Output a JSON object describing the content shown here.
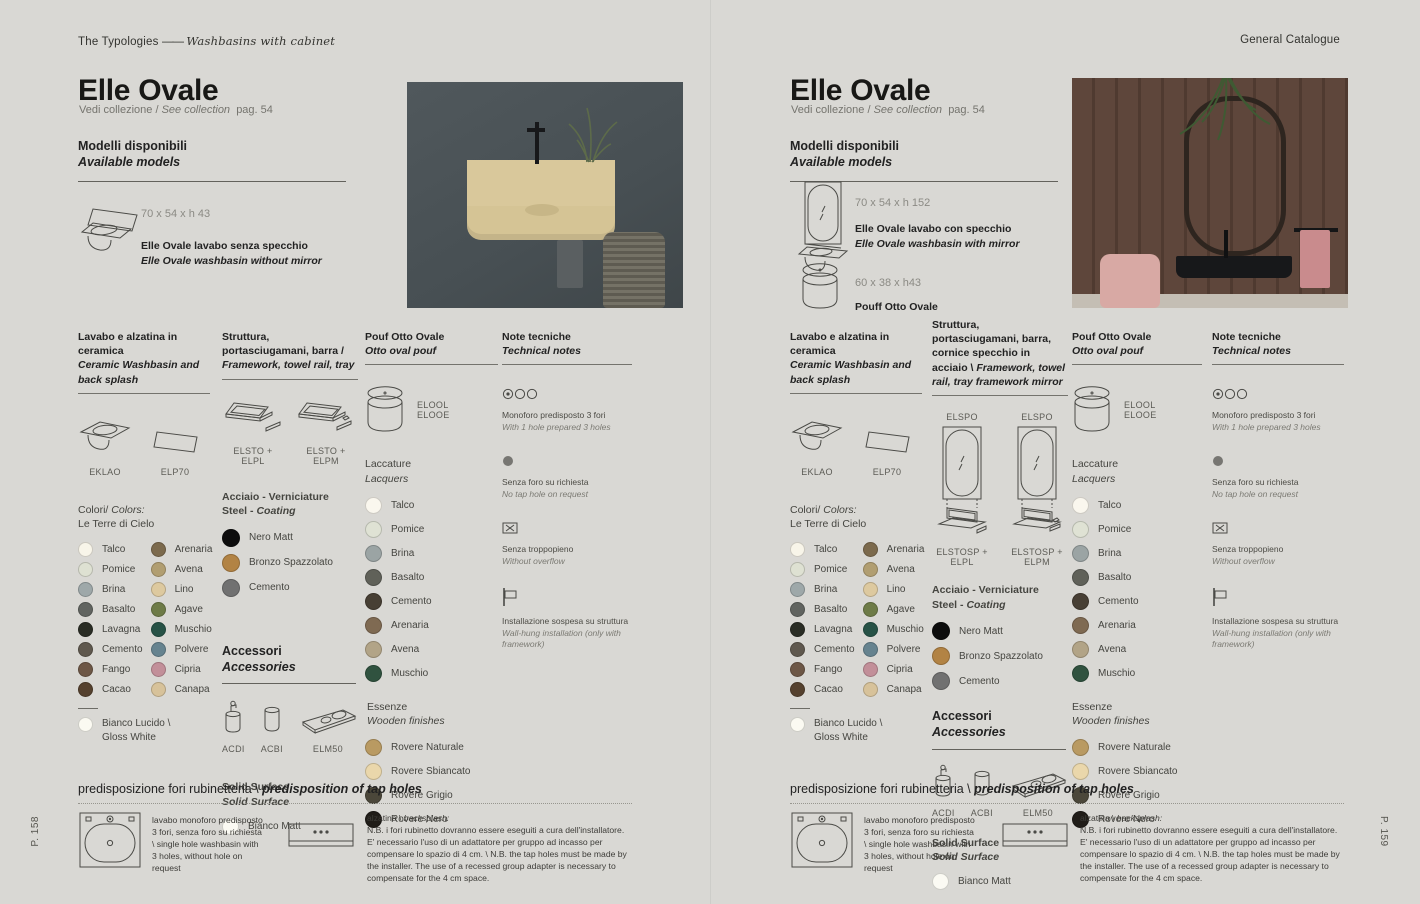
{
  "header": {
    "breadcrumb_section": "The Typologies",
    "breadcrumb_dash": "——",
    "breadcrumb_sub": "Washbasins with cabinet",
    "right_label": "General Catalogue"
  },
  "shared": {
    "colori": {
      "title_it": "Colori/ ",
      "title_en": "Colors:",
      "subtitle": "Le Terre di Cielo",
      "col1": [
        {
          "name": "Talco",
          "color": "#f8f5e9"
        },
        {
          "name": "Pomice",
          "color": "#dee1d2"
        },
        {
          "name": "Brina",
          "color": "#9ea8a9"
        },
        {
          "name": "Basalto",
          "color": "#616460"
        },
        {
          "name": "Lavagna",
          "color": "#2a2d25"
        },
        {
          "name": "Cemento",
          "color": "#5f584e"
        },
        {
          "name": "Fango",
          "color": "#6d5746"
        },
        {
          "name": "Cacao",
          "color": "#55412e"
        }
      ],
      "col2": [
        {
          "name": "Arenaria",
          "color": "#7c6a4d"
        },
        {
          "name": "Avena",
          "color": "#b19e71"
        },
        {
          "name": "Lino",
          "color": "#ddc99f"
        },
        {
          "name": "Agave",
          "color": "#6e7b47"
        },
        {
          "name": "Muschio",
          "color": "#275246"
        },
        {
          "name": "Polvere",
          "color": "#66838f"
        },
        {
          "name": "Cipria",
          "color": "#c28f99"
        },
        {
          "name": "Canapa",
          "color": "#d7c29a"
        }
      ],
      "extra_line1": "Bianco Lucido \\",
      "extra_line2": "Gloss White",
      "extra_color": "#fbfaf2"
    },
    "steel": {
      "title_it": "Acciaio - Verniciature",
      "title_en": "Steel - Coating",
      "items": [
        {
          "name": "Nero Matt",
          "color": "#0d0d0d"
        },
        {
          "name": "Bronzo Spazzolato",
          "color": "#b28344"
        },
        {
          "name": "Cemento",
          "color": "#717171"
        }
      ]
    },
    "laccature": {
      "title_it": "Laccature",
      "title_en": "Lacquers",
      "items": [
        {
          "name": "Talco",
          "color": "#faf7ee"
        },
        {
          "name": "Pomice",
          "color": "#dfe2d4"
        },
        {
          "name": "Brina",
          "color": "#9ba4a4"
        },
        {
          "name": "Basalto",
          "color": "#606159"
        },
        {
          "name": "Cemento",
          "color": "#473f34"
        },
        {
          "name": "Arenaria",
          "color": "#7f6a52"
        },
        {
          "name": "Avena",
          "color": "#b2a487"
        },
        {
          "name": "Muschio",
          "color": "#30523f"
        }
      ]
    },
    "essenze": {
      "title_it": "Essenze",
      "title_en": "Wooden finishes",
      "items": [
        {
          "name": "Rovere Naturale",
          "color": "#b99a62"
        },
        {
          "name": "Rovere Sbiancato",
          "color": "#ead7ab"
        },
        {
          "name": "Rovere Grigio",
          "color": "#4b473a"
        },
        {
          "name": "Rovere Nero",
          "color": "#201d18"
        }
      ]
    },
    "solid_surface": {
      "title_it": "Solid Surface",
      "title_en": "Solid Surface",
      "item_name": "Bianco Matt",
      "item_color": "#fbfaf3"
    },
    "accessori": {
      "title_it": "Accessori",
      "title_en": "Accessories",
      "codes": [
        "ACDI",
        "ACBI",
        "ELM50"
      ]
    },
    "notes": {
      "title_it": "Note tecniche",
      "title_en": "Technical notes",
      "items": [
        {
          "icon": "three-holes-icon",
          "it": "Monoforo predisposto 3 fori",
          "en": "With 1 hole prepared 3 holes"
        },
        {
          "icon": "no-hole-icon",
          "it": "Senza foro su richiesta",
          "en": "No tap hole on request"
        },
        {
          "icon": "no-overflow-icon",
          "it": "Senza troppopieno",
          "en": "Without overflow"
        },
        {
          "icon": "wall-hung-icon",
          "it": "Installazione sospesa su struttura",
          "en": "Wall-hung installation (only with framework)"
        }
      ]
    },
    "pouf_code_line1": "ELOOL",
    "pouf_code_line2": "ELOOE",
    "tap_holes": {
      "title_it": "predisposizione fori rubinetteria \\ ",
      "title_en": "predisposition of tap holes",
      "block1_text": "lavabo monoforo predisposto 3 fori, senza foro su richiesta \\ single hole washbasin with 3 holes, without hole on request",
      "block2_label_it": "alzatina \\ ",
      "block2_label_en": "backsplash:",
      "block2_text": "N.B. i fori rubinetto dovranno essere eseguiti a cura dell'installatore. E' necessario l'uso di un adattatore per gruppo ad incasso per compensare lo spazio di 4 cm. \\ N.B. the tap holes must be made by the installer. The use of a recessed group adapter is necessary to compensate for the 4 cm space."
    }
  },
  "left_page": {
    "title": "Elle Ovale",
    "subtitle_it": "Vedi collezione / ",
    "subtitle_en": "See collection",
    "subtitle_page": "pag. 54",
    "models_title_it": "Modelli disponibili",
    "models_title_en": "Available models",
    "model1_dims": "70 x 54 x h 43",
    "model1_desc_it": "Elle Ovale lavabo senza specchio",
    "model1_desc_en": "Elle Ovale washbasin without mirror",
    "col1_it": "Lavabo e alzatina in ceramica",
    "col1_en": "Ceramic Washbasin and back splash",
    "col2_it": "Struttura, portasciugamani, barra / ",
    "col2_en": "Framework, towel rail, tray",
    "col3_it": "Pouf Otto Ovale",
    "col3_en": "Otto oval pouf",
    "col4_it": "Note tecniche",
    "col4_en": "Technical notes",
    "code_basin": "EKLAO",
    "code_splash": "ELP70",
    "code_frame1": "ELSTO + ELPL",
    "code_frame2": "ELSTO + ELPM",
    "page_no": "P. 158"
  },
  "right_page": {
    "title": "Elle Ovale",
    "subtitle_it": "Vedi collezione / ",
    "subtitle_en": "See collection",
    "subtitle_page": "pag. 54",
    "models_title_it": "Modelli disponibili",
    "models_title_en": "Available models",
    "model1_dims": "70 x 54 x h 152",
    "model1_desc_it": "Elle Ovale lavabo con specchio",
    "model1_desc_en": "Elle Ovale washbasin with mirror",
    "model2_dims": "60 x 38 x h43",
    "model2_desc_it": "Pouff Otto Ovale",
    "col1_it": "Lavabo e alzatina in ceramica",
    "col1_en": "Ceramic Washbasin and back splash",
    "col2_it": "Struttura, portasciugamani, barra, cornice specchio in acciaio \\ ",
    "col2_en": "Framework, towel rail, tray framework mirror",
    "col3_it": "Pouf Otto Ovale",
    "col3_en": "Otto oval pouf",
    "col4_it": "Note tecniche",
    "col4_en": "Technical notes",
    "code_basin": "EKLAO",
    "code_splash": "ELP70",
    "code_mirror": "ELSPO",
    "code_frame1": "ELSTOSP + ELPL",
    "code_frame2": "ELSTOSP + ELPM",
    "page_no": "P. 159"
  },
  "photo_colors": {
    "left_wall": "#4d5559",
    "left_basin": "#d9c89b",
    "right_wood": "#5c453a",
    "right_towel": "#c98b8d",
    "right_pouf": "#d8a9a4"
  }
}
